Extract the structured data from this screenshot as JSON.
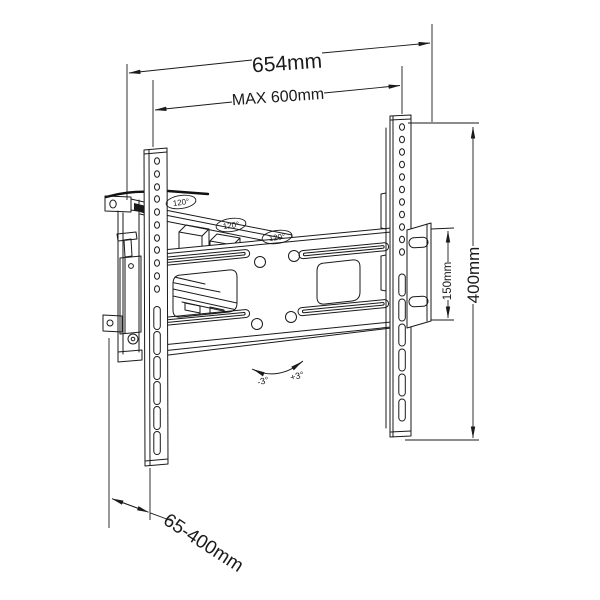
{
  "diagram": {
    "type": "technical-drawing",
    "subject": "Articulating TV wall mount bracket, dimensioned perspective view",
    "background": "#ffffff",
    "line_color": "#1a1a1a",
    "dimensions": {
      "overall_width": "654mm",
      "max_width": "MAX 600mm",
      "vesa_height": "400mm",
      "plate_hole_spacing": "150mm",
      "wall_distance_range": "65-400mm"
    },
    "angles": {
      "swivel": "120°",
      "tilt_negative": "-3°",
      "tilt_positive": "+3°"
    }
  }
}
